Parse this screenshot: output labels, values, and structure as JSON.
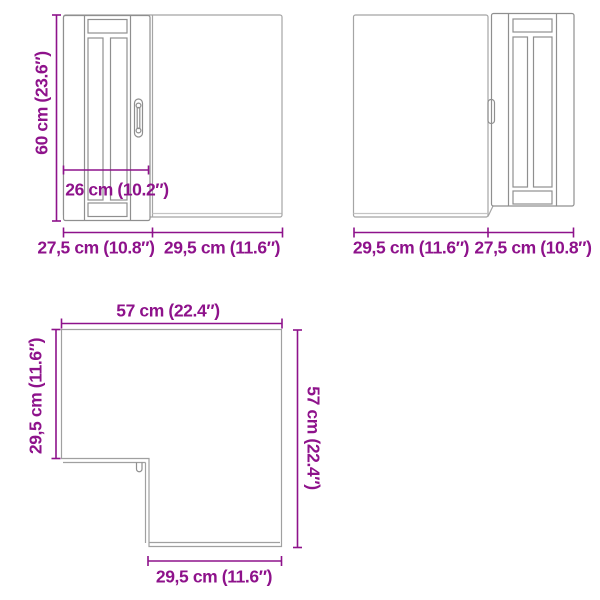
{
  "colors": {
    "dimension": "#8e128b",
    "outline_gray": "#9a9a9a",
    "background": "#ffffff"
  },
  "views": {
    "front_left": {
      "height": "60 cm (23.6″)",
      "inner_width": "26 cm (10.2″)",
      "bottom_left_width": "27,5 cm (10.8″)",
      "bottom_right_width": "29,5 cm (11.6″)"
    },
    "front_right": {
      "bottom_left_width": "29,5 cm (11.6″)",
      "bottom_right_width": "27,5 cm (10.8″)"
    },
    "top_view": {
      "top_width": "57 cm (22.4″)",
      "left_depth": "29,5 cm (11.6″)",
      "right_depth": "57 cm (22.4″)",
      "bottom_width": "29,5 cm (11.6″)"
    }
  }
}
